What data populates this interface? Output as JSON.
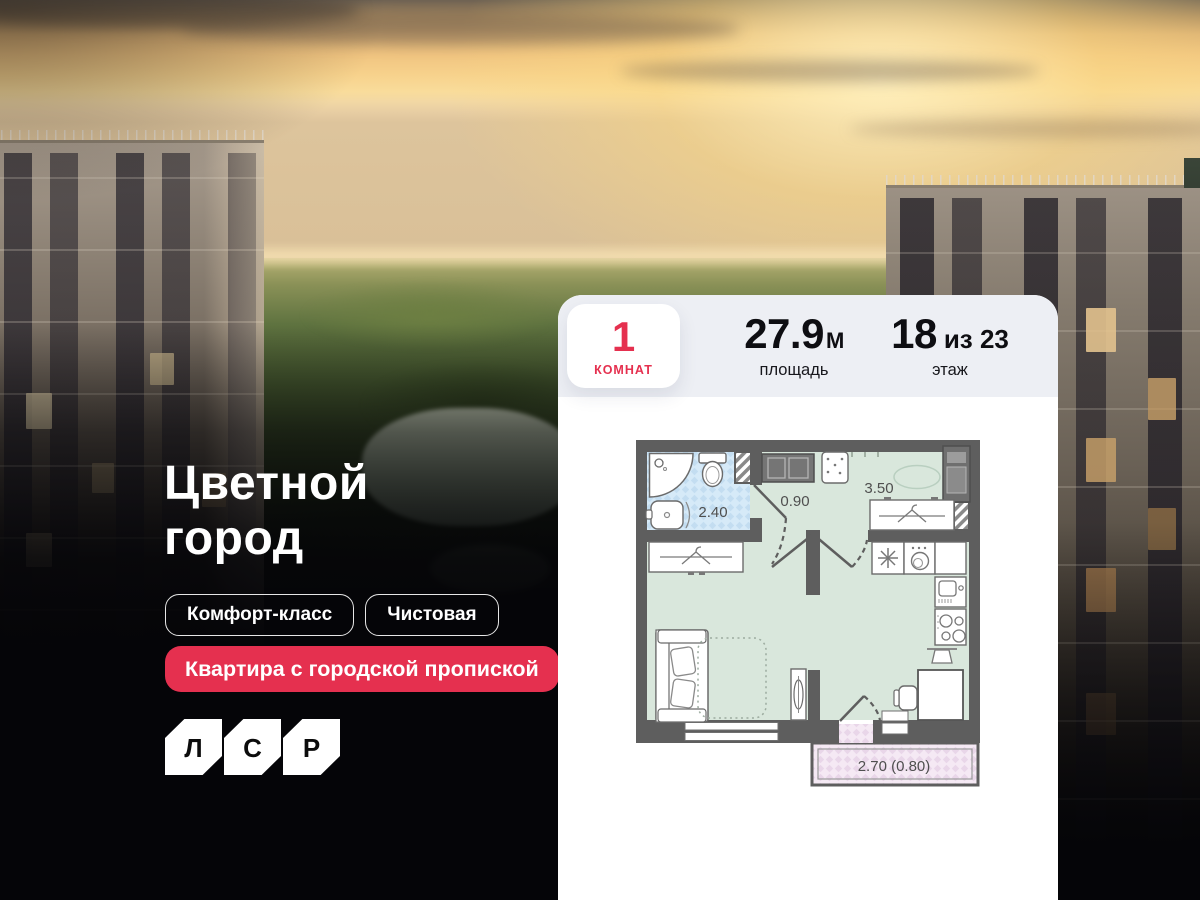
{
  "hero": {
    "title": "Цветной\nгород",
    "tags": [
      {
        "label": "Комфорт-класс"
      },
      {
        "label": "Чистовая"
      }
    ],
    "badge": "Квартира с городской пропиской",
    "developer": {
      "letters": [
        "Л",
        "С",
        "Р"
      ]
    }
  },
  "card": {
    "rooms": {
      "value": "1",
      "label": "КОМНАТ"
    },
    "area": {
      "value": "27.9",
      "unit": "М",
      "label": "площадь"
    },
    "floor": {
      "value": "18",
      "suffix": "из 23",
      "label": "этаж"
    }
  },
  "floorplan": {
    "labels": {
      "bathroom": "2.40",
      "hallway": "0.90",
      "kitchen_living": "3.50",
      "balcony": "2.70 (0.80)"
    }
  },
  "colors": {
    "accent_red": "#e5304f",
    "header_bg": "#edeff4",
    "wall_gray": "#5e5e5e",
    "floor_green": "#d9e7dc",
    "floor_blue": "#d6eaf8",
    "floor_pink": "#f5e9f4",
    "sky_gold": "#f7d28c"
  }
}
